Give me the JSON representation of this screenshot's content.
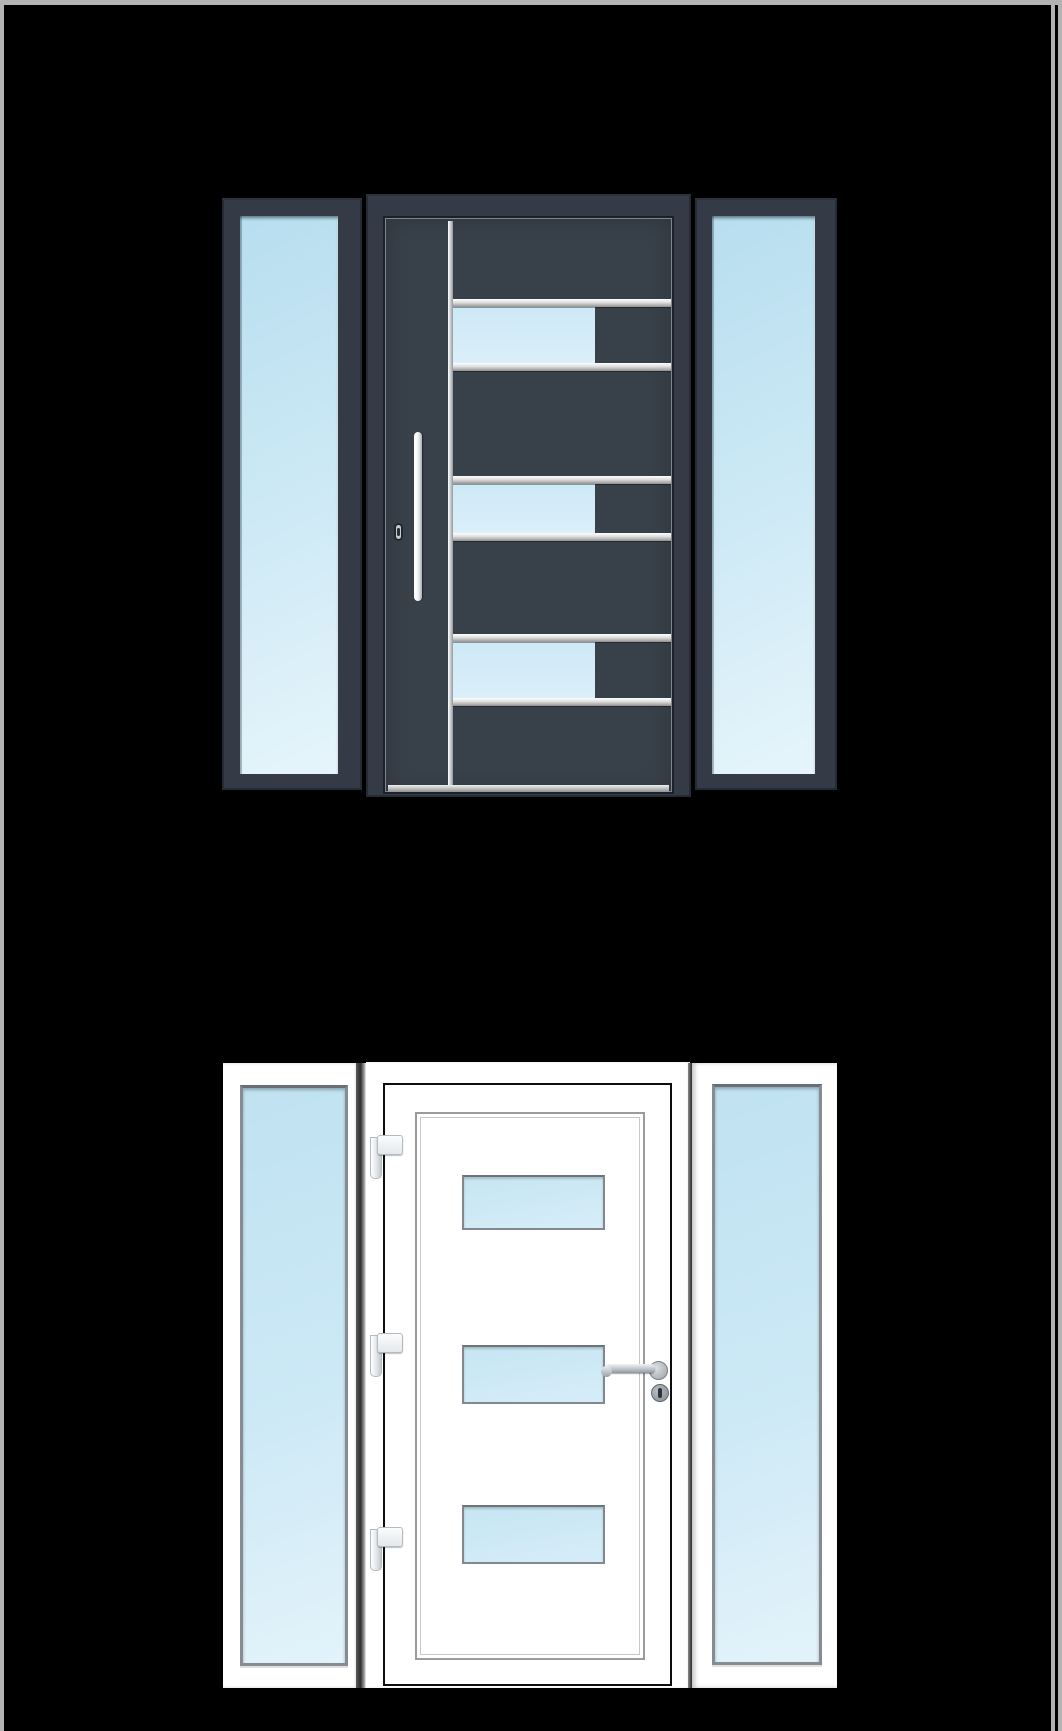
{
  "viewer": {
    "border": "gray frame on top, left and right edges",
    "scrollbar_present": true
  },
  "doors": [
    {
      "name": "anthracite entry door with two sidelights",
      "style": "dark",
      "sidelights": 2,
      "leaf_glass_panels": 3,
      "horizontal_glazing_bars": 6,
      "vertical_glazing_bar": true,
      "handle": "vertical stainless pull bar",
      "lock": "profile cylinder",
      "threshold": "silver"
    },
    {
      "name": "white entry door with two sidelights",
      "style": "white",
      "sidelights": 2,
      "leaf_glass_panels": 3,
      "hinges": 3,
      "handle": "stainless lever handle on rosette",
      "lock": "cylinder rosette",
      "inner_decorative_panel": true
    }
  ],
  "colors": {
    "bg": "#000000",
    "canvas_border": "#b3b3b3",
    "dark_frame": "#343b46",
    "dark_leaf": "#384049",
    "glass_light": "#b7deef",
    "glass_lighter": "#e6f5fb",
    "glass_row": "#cde9f6",
    "silver_dark": "#919191",
    "white": "#ffffff",
    "black_line": "#0d0d0d",
    "gray_outline": "#9b9b9b"
  }
}
